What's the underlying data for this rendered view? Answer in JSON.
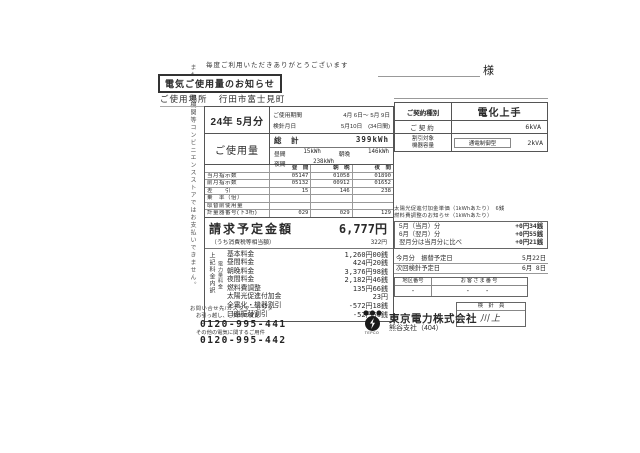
{
  "doc": {
    "thanks": "毎度ご利用いただきありがとうございます",
    "honorific": "様",
    "title": "電気ご使用量のお知らせ",
    "place_label": "ご使用場所",
    "place_value": "行田市富士見町",
    "side_note": "また、金融機関等コンビニエンスストアではお支払いできません。"
  },
  "billing": {
    "month": "24年 5月分",
    "period_label": "ご使用期間",
    "period_value": "4月 6日～ 5月 9日",
    "reading_label": "検針月日",
    "reading_value": "5月10日　(34日間)",
    "total_label": "総　計",
    "total_value": "399kWh",
    "usage_label": "ご使用量",
    "day_label": "昼間",
    "day_value": "15kWh",
    "morning_label": "朝晩",
    "morning_value": "146kWh",
    "night_label": "夜間",
    "night_value": "238kWh"
  },
  "meter": {
    "headers": [
      "昼　間",
      "朝　晩",
      "夜　間"
    ],
    "rows": [
      {
        "label": "当月指示数",
        "v": [
          "05147",
          "01058",
          "01890"
        ]
      },
      {
        "label": "前月指示数",
        "v": [
          "05132",
          "00912",
          "01652"
        ]
      },
      {
        "label": "差　　引",
        "v": [
          "15",
          "146",
          "238"
        ]
      },
      {
        "label": "乗　率（倍）",
        "v": [
          "",
          "",
          ""
        ]
      },
      {
        "label": "取替前使用量",
        "v": [
          "",
          "",
          ""
        ]
      },
      {
        "label": "計量器番号(下3桁)",
        "v": [
          "029",
          "029",
          "129"
        ]
      }
    ]
  },
  "invoice": {
    "amount_label": "請求予定金額",
    "amount_value": "6,777円",
    "tax_label": "（うち消費税等相当額）",
    "tax_value": "322円",
    "outer_label": "上記料金内訳",
    "inner_label": "電力量料金",
    "rows": [
      {
        "label": "基本料金",
        "value": "1,260円00銭"
      },
      {
        "label": "昼間料金",
        "value": "424円20銭"
      },
      {
        "label": "朝晩料金",
        "value": "3,376円98銭"
      },
      {
        "label": "夜間料金",
        "value": "2,182円46銭"
      },
      {
        "label": "燃料費調整",
        "value": "135円66銭"
      },
      {
        "label": "太陽光促進付加金",
        "value": "23円"
      },
      {
        "label": "全電化・機器割引",
        "value": "-572円18銭"
      },
      {
        "label": "口座振替割引",
        "value": "-52円50銭"
      }
    ]
  },
  "contract": {
    "type_label": "ご契約種別",
    "type_value": "電化上手",
    "amount_label": "ご契約",
    "amount_value": "6kVA",
    "device_label1": "割引対象",
    "device_label2": "機器容量",
    "device_type": "通電制御型",
    "device_value": "2kVA"
  },
  "notice": {
    "solar_line": "太陽光促進付加金単価（1kWhあたり）　6銭",
    "fuel_line": "燃料費調整のお知らせ（1kWhあたり）",
    "rows": [
      {
        "label": "5月（当月）分",
        "value": "+0円34銭"
      },
      {
        "label": "6月（翌月）分",
        "value": "+0円55銭"
      },
      {
        "label": "翌月分は当月分に比べ",
        "value": "+0円21銭"
      }
    ]
  },
  "schedule": {
    "transfer_label": "今月分　振替予定日",
    "transfer_value": "5月22日",
    "next_label": "次回検針予定日",
    "next_value": "6月 8日",
    "area_label": "地区番号",
    "customer_label": "お客さま番号",
    "area_value": "-",
    "customer_value": "-　-",
    "reader_label": "検　針　員",
    "reader_value": "川上"
  },
  "footer": {
    "contact_title": "お問い合せ先/カスタマーセンター",
    "moving_label": "お引っ越し、ご契約の変更",
    "moving_phone": "0120-995-441",
    "other_label": "その他の電気に関するご用件",
    "other_phone": "0120-995-442",
    "logo_text": "TEPCO",
    "company": "東京電力株式会社",
    "branch": "熊谷支社（404）"
  }
}
